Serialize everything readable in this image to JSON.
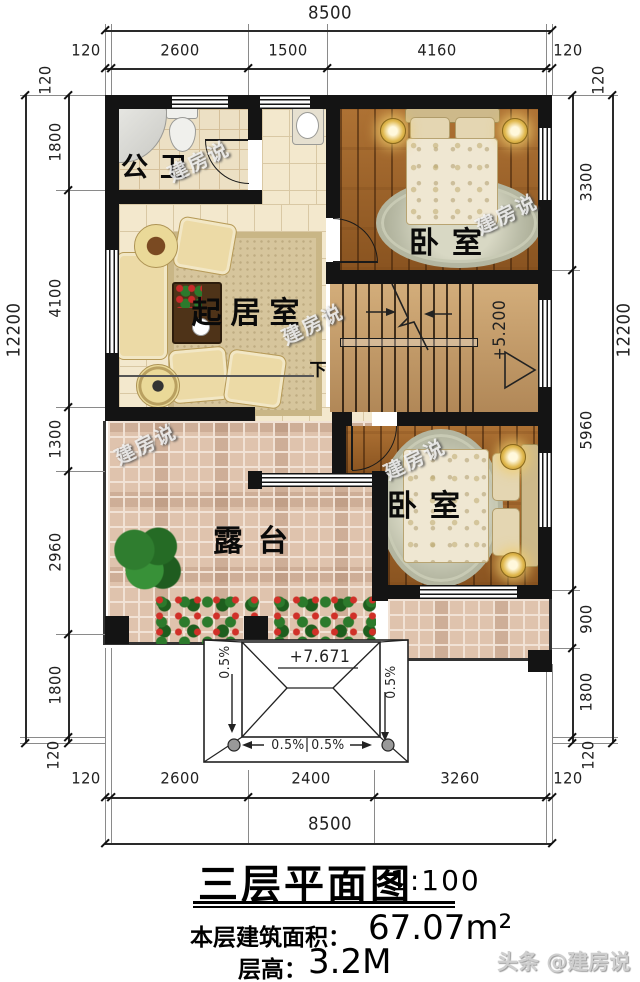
{
  "title_block": {
    "title": "三层平面图",
    "scale": "1:100",
    "area_label": "本层建筑面积：",
    "area_value": "67.07m²",
    "floor_height_label": "层高：",
    "floor_height_value": "3.2M"
  },
  "watermark": {
    "text": "建房说",
    "footer": "头条 @建房说"
  },
  "rooms": {
    "bathroom": "公卫",
    "living_room": "起居室",
    "bedroom_top": "卧室",
    "bedroom_bottom": "卧室",
    "terrace": "露台"
  },
  "stairs": {
    "down_label": "下",
    "elevation": "+5.200"
  },
  "porch_roof": {
    "elevation": "+7.671",
    "slope_left": "0.5%",
    "slope_right": "0.5%",
    "slope_bottom_left": "0.5%",
    "slope_bottom_right": "0.5%"
  },
  "dimensions": {
    "top": {
      "total": "8500",
      "segments": [
        "120",
        "2600",
        "1500",
        "4160",
        "120"
      ]
    },
    "bottom": {
      "total": "8500",
      "segments": [
        "120",
        "2600",
        "2400",
        "3260",
        "120"
      ]
    },
    "left": {
      "total": "12200",
      "segments": [
        "120",
        "1800",
        "4100",
        "1300",
        "2960",
        "1800",
        "120"
      ]
    },
    "right": {
      "total": "12200",
      "segments": [
        "120",
        "3300",
        "5960",
        "900",
        "1800",
        "120"
      ]
    }
  },
  "colors": {
    "wall": "#141414",
    "wood_floor": "#9c6127",
    "tile_floor": "#f3e8cd",
    "terrace_tile": "#dfc3ad",
    "stair_floor": "#c49a67"
  }
}
